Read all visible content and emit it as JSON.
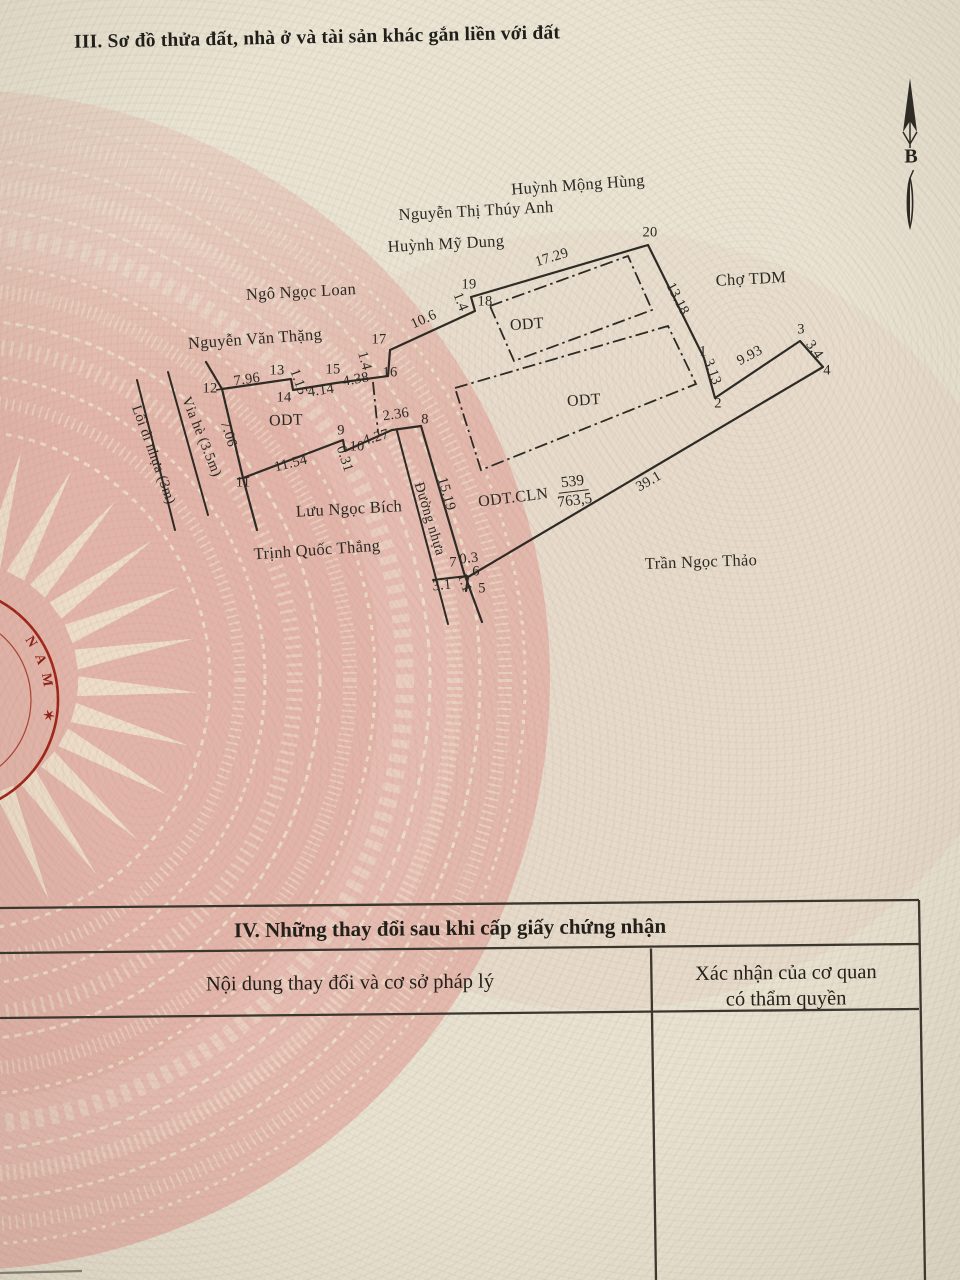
{
  "section3": {
    "title": "III. Sơ đồ thửa đất, nhà ở và tài sản khác gắn liền với đất"
  },
  "compass": {
    "north_label": "B"
  },
  "diagram": {
    "neighbors": [
      "Huỳnh Mộng Hùng",
      "Nguyễn Thị Thúy Anh",
      "Huỳnh Mỹ Dung",
      "Ngô Ngọc Loan",
      "Nguyễn Văn Thặng",
      "Chợ TDM",
      "Lưu Ngọc Bích",
      "Trịnh Quốc Thắng",
      "Trần Ngọc Thảo"
    ],
    "roads": [
      "Vỉa hè (3.5m)",
      "Lối đi nhựa (3m)",
      "Đường nhựa"
    ],
    "zones": [
      "ODT",
      "ODT",
      "ODT"
    ],
    "area_note": {
      "prefix": "ODT.CLN",
      "numerator": "539",
      "denominator": "763,5"
    },
    "measurements": [
      "17.29",
      "13.18",
      "10.6",
      "1.4",
      "1.4",
      "7.96",
      "1.15",
      "4.14",
      "4.38",
      "7.06",
      "11.54",
      "0.31",
      "4.27",
      "2.36",
      "15.19",
      "3.1",
      "1.1",
      "0.3",
      "3.13",
      "9.93",
      "3.4",
      "39.1"
    ],
    "vertices": [
      "1",
      "2",
      "3",
      "4",
      "5",
      "6",
      "7",
      "8",
      "9",
      "10",
      "11",
      "12",
      "13",
      "14",
      "15",
      "16",
      "17",
      "18",
      "19",
      "20"
    ],
    "stamp_text": "NAM ✶"
  },
  "section4": {
    "title": "IV. Những thay đổi sau khi cấp giấy chứng nhận",
    "col1_header": "Nội dung thay đổi và cơ sở pháp lý",
    "col2_header_line1": "Xác nhận của cơ quan",
    "col2_header_line2": "có thẩm quyền"
  },
  "colors": {
    "ink": "#2e2b25",
    "stamp_red": "#9e2317",
    "emblem_pink": "#e2b3a9",
    "paper": "#e9e4d3"
  }
}
